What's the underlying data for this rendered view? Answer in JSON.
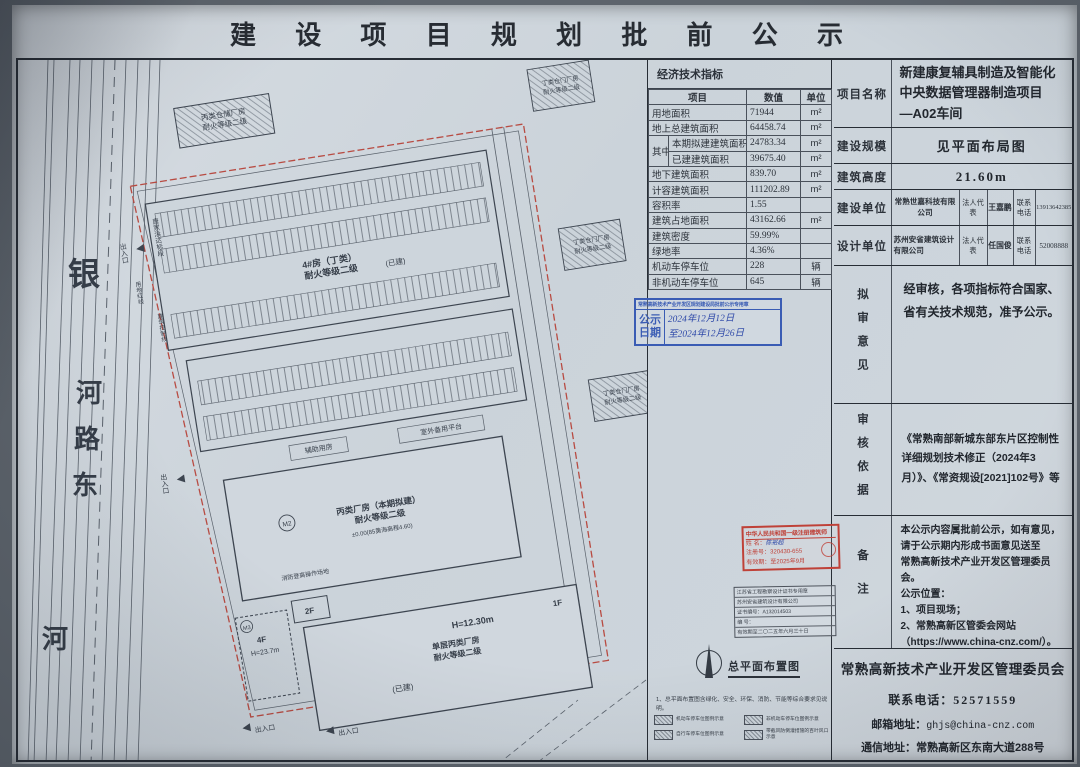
{
  "title": "建 设 项 目 规 划 批 前 公 示",
  "econ": {
    "title": "经济技术指标",
    "headers": {
      "item": "项目",
      "value": "数值",
      "unit": "单位"
    },
    "group_label": "其中",
    "rows": [
      {
        "item": "用地面积",
        "value": "71944",
        "unit": "m²",
        "sub": false
      },
      {
        "item": "地上总建筑面积",
        "value": "64458.74",
        "unit": "m²",
        "sub": false
      },
      {
        "item": "本期拟建建筑面积",
        "value": "24783.34",
        "unit": "m²",
        "sub": true
      },
      {
        "item": "已建建筑面积",
        "value": "39675.40",
        "unit": "m²",
        "sub": true
      },
      {
        "item": "地下建筑面积",
        "value": "839.70",
        "unit": "m²",
        "sub": false
      },
      {
        "item": "计容建筑面积",
        "value": "111202.89",
        "unit": "m²",
        "sub": false
      },
      {
        "item": "容积率",
        "value": "1.55",
        "unit": "",
        "sub": false
      },
      {
        "item": "建筑占地面积",
        "value": "43162.66",
        "unit": "m²",
        "sub": false
      },
      {
        "item": "建筑密度",
        "value": "59.99%",
        "unit": "",
        "sub": false
      },
      {
        "item": "绿地率",
        "value": "4.36%",
        "unit": "",
        "sub": false
      },
      {
        "item": "机动车停车位",
        "value": "228",
        "unit": "辆",
        "sub": false
      },
      {
        "item": "非机动车停车位",
        "value": "645",
        "unit": "辆",
        "sub": false
      }
    ]
  },
  "notice_stamp": {
    "header": "常熟高新技术产业开发区规划建设局批前公示专用章",
    "label": "公示日期",
    "date_from": "2024年12月12日",
    "date_to": "至2024年12月26日"
  },
  "architect_stamp": {
    "title": "中华人民共和国一级注册建筑师",
    "name_label": "姓 名：",
    "name": "陈裕超",
    "reg_label": "注册号：",
    "reg": "320430-655",
    "valid_label": "有效期：",
    "valid": "至2025年9月"
  },
  "firm_stamp": {
    "title": "江苏省工程勘察设计证书专用章",
    "company": "苏州安省建筑设计有限公司",
    "cert": "证书编号：A132014503",
    "serial": "编  号：",
    "valid": "有效期至二〇二五年六月三十日"
  },
  "legend": {
    "compass_label": "总平面布置图",
    "note": "1、总平面布置图含绿化、安全、环保、消防、节能等综合要求见说明。",
    "items": [
      "机动车停车位图例示意",
      "非机动车停车位图例示意",
      "自行车停车位图例示意",
      "带截风防倒灌措施的百叶风口示意"
    ]
  },
  "info": {
    "project_label": "项目名称",
    "project_name": "新建康复辅具制造及智能化中央数据管理器制造项目　　—A02车间",
    "scale_label": "建设规模",
    "scale": "见平面布局图",
    "height_label": "建筑高度",
    "height": "21.60m",
    "builder_label": "建设单位",
    "builder": "常熟世嘉科技有限公司",
    "legal_label": "法人代表",
    "builder_legal": "王嘉鹏",
    "phone_label": "联系电话",
    "builder_phone": "13913642385",
    "designer_label": "设计单位",
    "designer": "苏州安省建筑设计有限公司",
    "designer_legal": "任国俊",
    "designer_phone": "52008888",
    "opinion_label": "拟审意见",
    "opinion": "经审核，各项指标符合国家、省有关技术规范，准予公示。",
    "basis_label": "审核依据",
    "basis": "《常熟南部新城东部东片区控制性详细规划技术修正（2024年3月）》、《常资规设[2021]102号》等",
    "remark_label": "备注",
    "remark": "本公示内容属批前公示，如有意见，\n请于公示期内形成书面意见送至\n常熟高新技术产业开发区管理委员会。\n公示位置：\n1、项目现场；\n2、常熟高新区管委会网站\n（https://www.china-cnz.com/）。"
  },
  "footer": {
    "org": "常熟高新技术产业开发区管理委员会",
    "phone_label": "联系电话：",
    "phone": "52571559",
    "email_label": "邮箱地址：",
    "email": "ghjs@china-cnz.com",
    "address_label": "通信地址：",
    "address": "常熟高新区东南大道288号"
  },
  "drawing": {
    "road_name": [
      "银",
      "河",
      "路",
      "东"
    ],
    "river": "河",
    "labels": {
      "canal": "唐家浜达标段",
      "warehouse_top_1": "丙类仓储厂房",
      "warehouse_top_2": "耐火等级二级",
      "east_1": "丁类仓门厂房",
      "east_2": "耐火等级二级",
      "b1_1": "4#房（丁类）",
      "b1_2": "耐火等级二级",
      "b1_tag": "(已建)",
      "aux": "辅助用房",
      "platform": "室外备用平台",
      "b3_mark": "M2",
      "b3_1": "丙类厂房（本期拟建）",
      "b3_2": "耐火等级二级",
      "b3_lvl": "±0.00(85黄海高程4.60)",
      "b4_1": "单层丙类厂房",
      "b4_2": "耐火等级二级",
      "b4_h": "H=12.30m",
      "b4_f": "1F",
      "b4_tag": "(已建)",
      "b5_mark": "M3",
      "b5_f": "4F",
      "b5_h": "H=23.7m",
      "b6_f": "2F",
      "fire": "消防登高操作场地",
      "line_red": "用地红线",
      "line_ctrl": "建筑控制线",
      "entrance": "出入口"
    }
  }
}
